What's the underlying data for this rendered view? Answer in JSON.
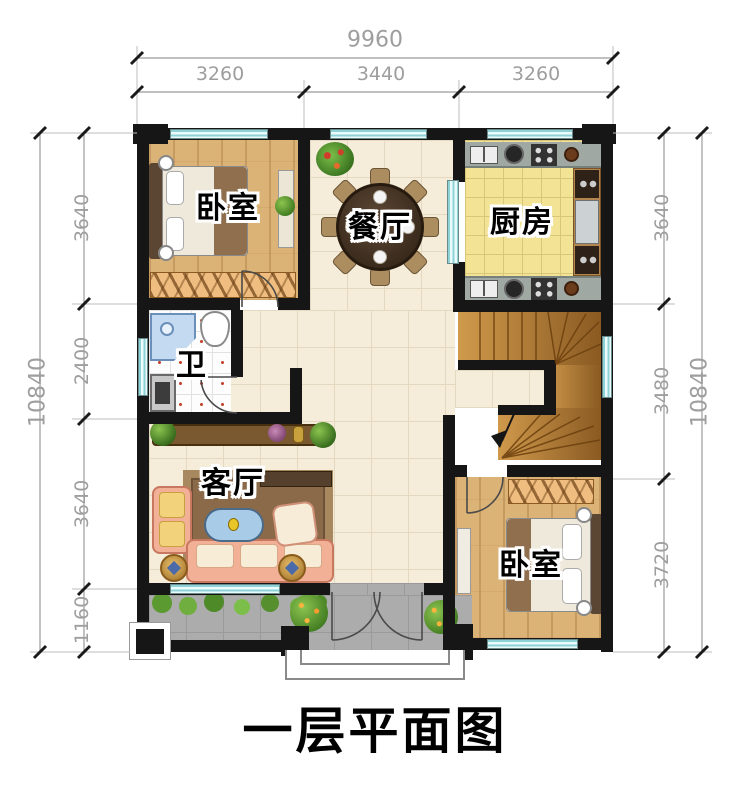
{
  "title": "一层平面图",
  "rooms": {
    "bedroom_top": "卧室",
    "dining": "餐厅",
    "kitchen": "厨房",
    "bathroom": "卫",
    "living": "客厅",
    "bedroom_bottom": "卧室"
  },
  "dimensions": {
    "top": {
      "total": "9960",
      "segments": [
        "3260",
        "3440",
        "3260"
      ]
    },
    "left": {
      "total": "10840",
      "segments": [
        "3640",
        "2400",
        "3640",
        "1160"
      ]
    },
    "right": {
      "total": "10840",
      "segments": [
        "3640",
        "3480",
        "3720"
      ]
    }
  },
  "colors": {
    "wall": "#161616",
    "window": "#bfe9ea",
    "wood_floor": "#dcb377",
    "kitchen_floor": "#f2e494",
    "hall_floor": "#f5ecd9",
    "porch_paving": "#acacac",
    "stair_wood": "#c08a3e",
    "dimension_text": "#9e9e9e"
  }
}
